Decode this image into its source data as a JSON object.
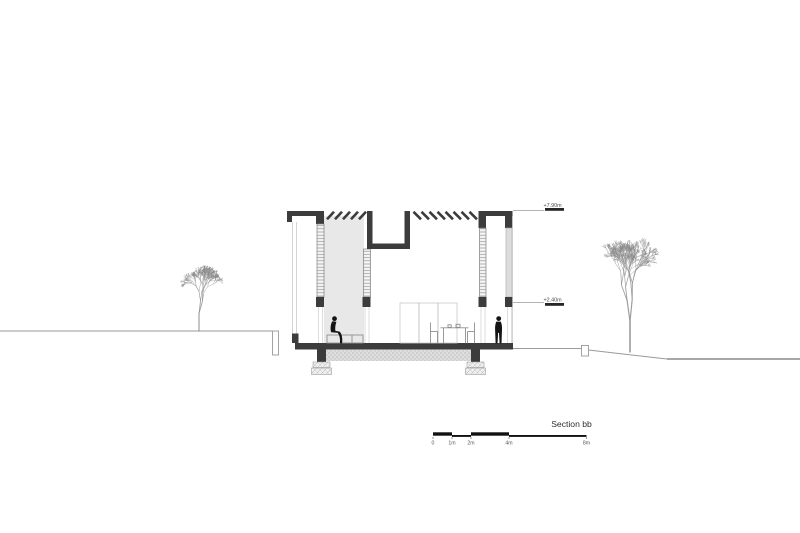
{
  "drawing": {
    "title": "Section bb",
    "levels": {
      "roof": "+7.90m",
      "lintel": "+2.40m"
    },
    "scale_bar": {
      "labels": [
        "0",
        "1m",
        "2m",
        "4m",
        "8m"
      ]
    },
    "colors": {
      "cut_elements": "#3c3c3c",
      "shaded_volume": "#e8e8e8",
      "ground_line": "#9a9a9a",
      "tree_line": "#8b8b8b",
      "figure_silhouette": "#141414",
      "background": "#ffffff"
    }
  }
}
